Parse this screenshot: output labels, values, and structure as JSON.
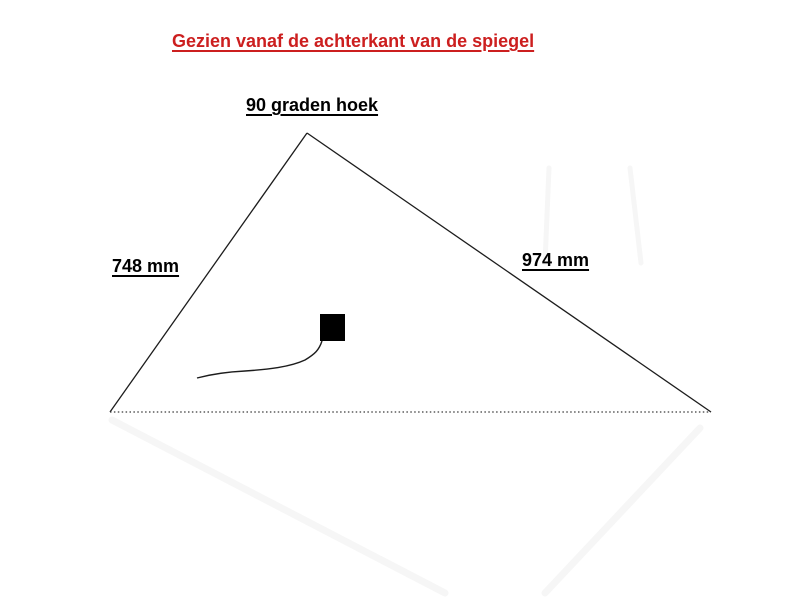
{
  "title": {
    "text": "Gezien vanaf de achterkant van de spiegel",
    "color": "#cc1f1f"
  },
  "diagram": {
    "angle_label": "90 graden hoek",
    "left_side_label": "748 mm",
    "right_side_label": "974 mm",
    "line_color": "#1c1c1c",
    "dotted_line_color": "#3a3a3a",
    "square_color": "#000000",
    "artifact_color": "#f6f6f6"
  }
}
